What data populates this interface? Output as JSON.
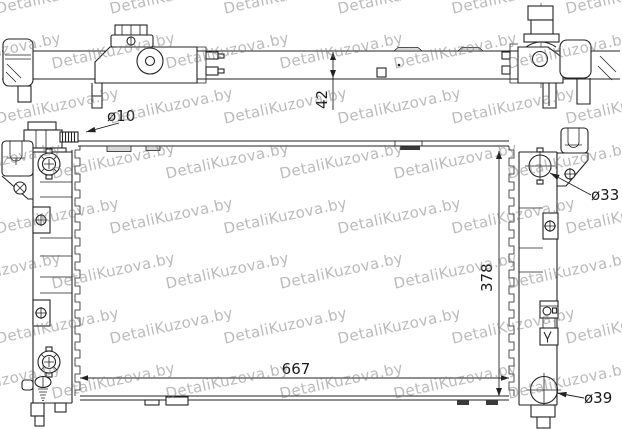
{
  "watermark": {
    "text": "DetaliKuzova.by"
  },
  "drawing": {
    "dimensions": {
      "core_width": "667",
      "core_height": "378",
      "core_depth": "42"
    },
    "diameters": {
      "filler_neck": "ø10",
      "inlet_port": "ø33",
      "outlet_port": "ø39"
    }
  },
  "colors": {
    "background": "#ffffff",
    "line": "#232323",
    "clip_fill": "#d8d8d8",
    "watermark": "#787878",
    "watermark_opacity": 0.5
  }
}
